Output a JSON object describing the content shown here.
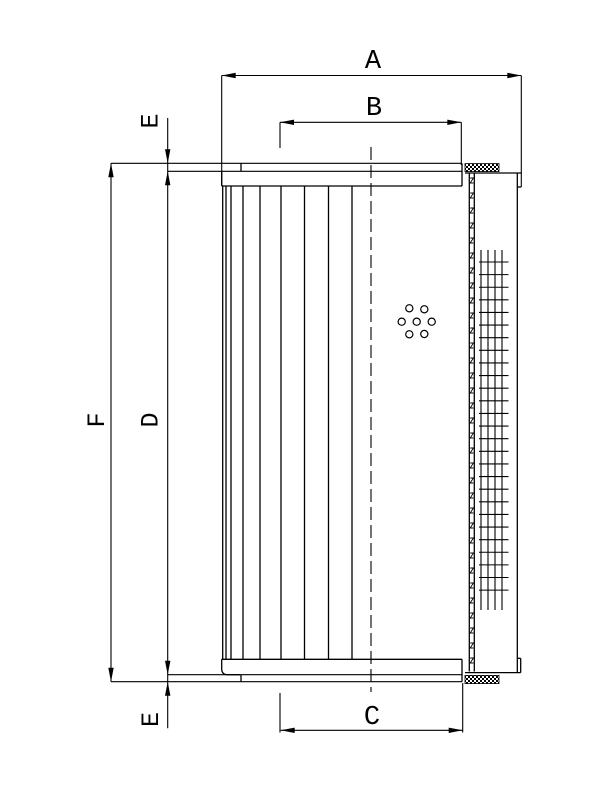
{
  "drawing": {
    "kind": "filter element dimensional drawing",
    "background": "#ffffff",
    "line_color": "#000000"
  },
  "labels": {
    "a": "A",
    "b": "B",
    "c": "C",
    "d": "D",
    "f": "F",
    "e_top": "E",
    "e_bottom": "E"
  },
  "geometry": {
    "pleats": {
      "xs": [
        222.7,
        226,
        231,
        243,
        260,
        281,
        304.5,
        328.5,
        352
      ],
      "y1": 186,
      "y2": 659.3
    },
    "holes": {
      "r": 3.6,
      "centers": [
        [
          409.3,
          308.3
        ],
        [
          424.3,
          309.3
        ],
        [
          401.7,
          321.7
        ],
        [
          416.7,
          321.7
        ],
        [
          431.7,
          321.7
        ],
        [
          409.3,
          334.3
        ],
        [
          424.3,
          334
        ]
      ]
    },
    "mesh": {
      "cols": [
        481,
        488,
        495,
        502
      ],
      "col_y1": 250,
      "col_y2": 610,
      "row_x1": 479,
      "row_x2": 508.5,
      "row_y1": 262,
      "row_y2": 590.5,
      "row_step": 12.62
    },
    "seam": {
      "x1": 470.2,
      "x2": 473.4,
      "y_start": 178,
      "y_end": 668,
      "step": 15,
      "glyph_h": 5
    },
    "centerline": {
      "x": 371,
      "y1": 147,
      "y2": 692,
      "dash": "13 5"
    }
  }
}
